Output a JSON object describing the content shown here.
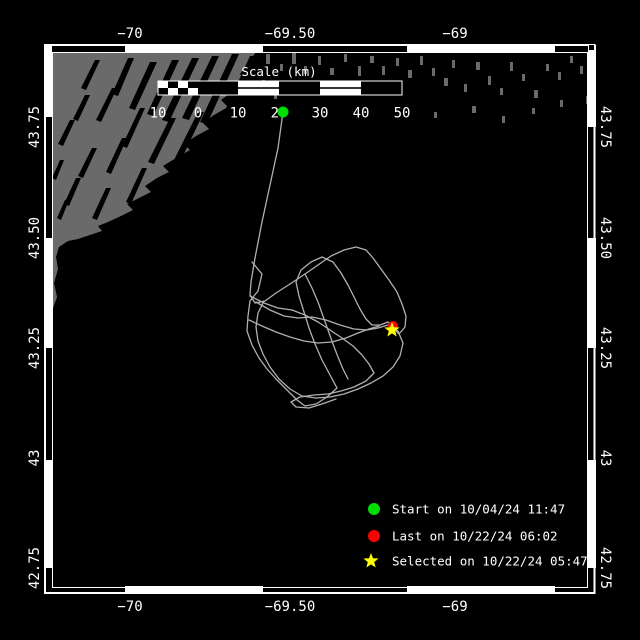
{
  "axis": {
    "top": [
      "−70",
      "−69.50",
      "−69"
    ],
    "bottom": [
      "−70",
      "−69.50",
      "−69"
    ],
    "left": [
      "43.75",
      "43.50",
      "43.25",
      "43",
      "42.75"
    ],
    "right": [
      "43.75",
      "43.50",
      "43.25",
      "43",
      "42.75"
    ]
  },
  "scalebar": {
    "title": "Scale (km)",
    "labels": [
      "10",
      "0",
      "10",
      "20",
      "30",
      "40",
      "50"
    ]
  },
  "legend": {
    "items": [
      {
        "marker": "green-circle",
        "label": "Start on 10/04/24 11:47"
      },
      {
        "marker": "red-circle",
        "label": "Last on 10/22/24 06:02"
      },
      {
        "marker": "yellow-star",
        "label": "Selected on 10/22/24 05:47"
      }
    ]
  },
  "colors": {
    "background": "#000000",
    "frame": "#ffffff",
    "land": "#6a6a6a",
    "track": "#b0b0b0",
    "start_marker": "#00dd00",
    "last_marker": "#ff0000",
    "selected_marker": "#ffff00"
  },
  "map": {
    "land_outline": "52,52 256,52 249,62 240,74 246,82 233,91 221,100 228,107 214,115 203,123 209,129 196,136 184,144 190,150 176,158 163,166 169,172 157,178 145,186 151,192 139,198 127,204 133,210 121,216 108,222 98,226 102,231 90,235 78,239 68,241 59,247 56,257 58,269 54,283 57,297 52,311",
    "coast_streaks": "M128,58 l6,0 l-16,38 l-6,-2 z M150,62 l7,0 l-22,48 l-6,-2 z M172,60 l7,0 l-26,56 l-6,-2 z M192,58 l7,0 l-30,64 l-7,-2 z M212,56 l7,0 l-30,64 l-7,-2 z M232,54 l7,0 l-32,70 l-7,-2 z M250,56 l6,0 l-34,76 l-6,-2 z M257,74 l6,0 l-30,66 l-6,-2 z M95,60 l5,0 l-14,30 l-5,-2 z M112,88 l5,0 l-16,34 l-5,-2 z M140,108 l5,0 l-18,40 l-5,-2 z M170,118 l6,0 l-22,46 l-6,-2 z M198,112 l6,0 l-24,50 l-6,-2 z M122,138 l5,0 l-16,36 l-5,-2 z M92,148 l5,0 l-14,30 l-5,-2 z M76,178 l5,0 l-12,28 l-5,-2 z M106,188 l5,0 l-14,32 l-5,-2 z M142,168 l5,0 l-16,36 l-5,-2 z M70,120 l5,0 l-12,26 l-5,-2 z M85,95 l5,0 l-12,26 l-5,-2 z M60,160 l4,0 l-8,20 l-4,-2 z M65,200 l4,0 l-8,20 l-4,-2 z",
    "islands": "M266,54 h4 v10 h-4 z M280,64 h3 v7 h-3 z M292,52 h4 v12 h-4 z M304,66 h3 v8 h-3 z M318,56 h3 v9 h-3 z M330,68 h4 v7 h-4 z M344,54 h3 v8 h-3 z M358,66 h3 v10 h-3 z M370,56 h4 v7 h-4 z M382,66 h3 v9 h-3 z M396,58 h3 v8 h-3 z M408,70 h4 v8 h-4 z M420,56 h3 v9 h-3 z M432,68 h3 v8 h-3 z M444,78 h4 v8 h-4 z M452,60 h3 v8 h-3 z M464,84 h3 v8 h-3 z M476,62 h4 v8 h-4 z M488,76 h3 v9 h-3 z M500,88 h3 v7 h-3 z M510,62 h3 v9 h-3 z M522,74 h3 v7 h-3 z M534,90 h4 v8 h-4 z M546,64 h3 v7 h-3 z M558,72 h3 v8 h-3 z M570,56 h3 v7 h-3 z M580,66 h3 v8 h-3 z M472,106 h4 v7 h-4 z M434,112 h3 v6 h-3 z M502,116 h3 v7 h-3 z M532,108 h3 v6 h-3 z M560,100 h3 v7 h-3 z M586,96 h3 v8 h-3 z M262,80 h3 v8 h-3 z M274,92 h3 v7 h-3 z"
  },
  "track": {
    "segments": [
      "283,112 278,148 270,185 262,222 255,258 251,282 250,295 255,303 265,301 276,293 290,284 305,274 318,265 331,256 344,250 356,247 366,250 373,258 381,269 389,280 397,292 402,304 406,316 405,327 399,334 393,328",
      "252,262 262,274 258,291 250,301 248,316 247,331 252,345 259,358 267,369 277,380 288,391 297,400 305,406 316,404 327,397 337,388 330,375 322,360 315,344 309,328 304,312 299,296 296,282 301,270 311,262 322,257 333,262 341,273 348,285 354,297 360,309 366,319 372,325 380,325 388,322 393,327",
      "256,302 270,310 284,316 298,318 312,317 326,320 340,325 354,329 367,330 378,328 388,325 398,331 403,343 400,356 393,367 383,376 371,383 358,389 344,394 330,397 316,398 302,396 290,389 279,379 270,367 263,354 258,341 256,327 258,313 264,301",
      "250,296 264,303 278,308 292,310 305,315 318,322 330,330 342,338 353,346 362,355 369,364 374,373 366,381 354,387 341,391 328,394 314,395 300,397 291,402 296,407 309,408 322,404 336,399",
      "249,320 262,326 276,332 290,337 304,341 318,343 332,342 346,338 358,333 369,329 379,326",
      "305,274 312,288 318,302 323,316 328,330 333,344 338,357 343,369 348,379"
    ]
  },
  "markers": {
    "start": {
      "x": 283,
      "y": 112
    },
    "last": {
      "x": 393,
      "y": 326
    },
    "selected": {
      "x": 392,
      "y": 330
    }
  }
}
